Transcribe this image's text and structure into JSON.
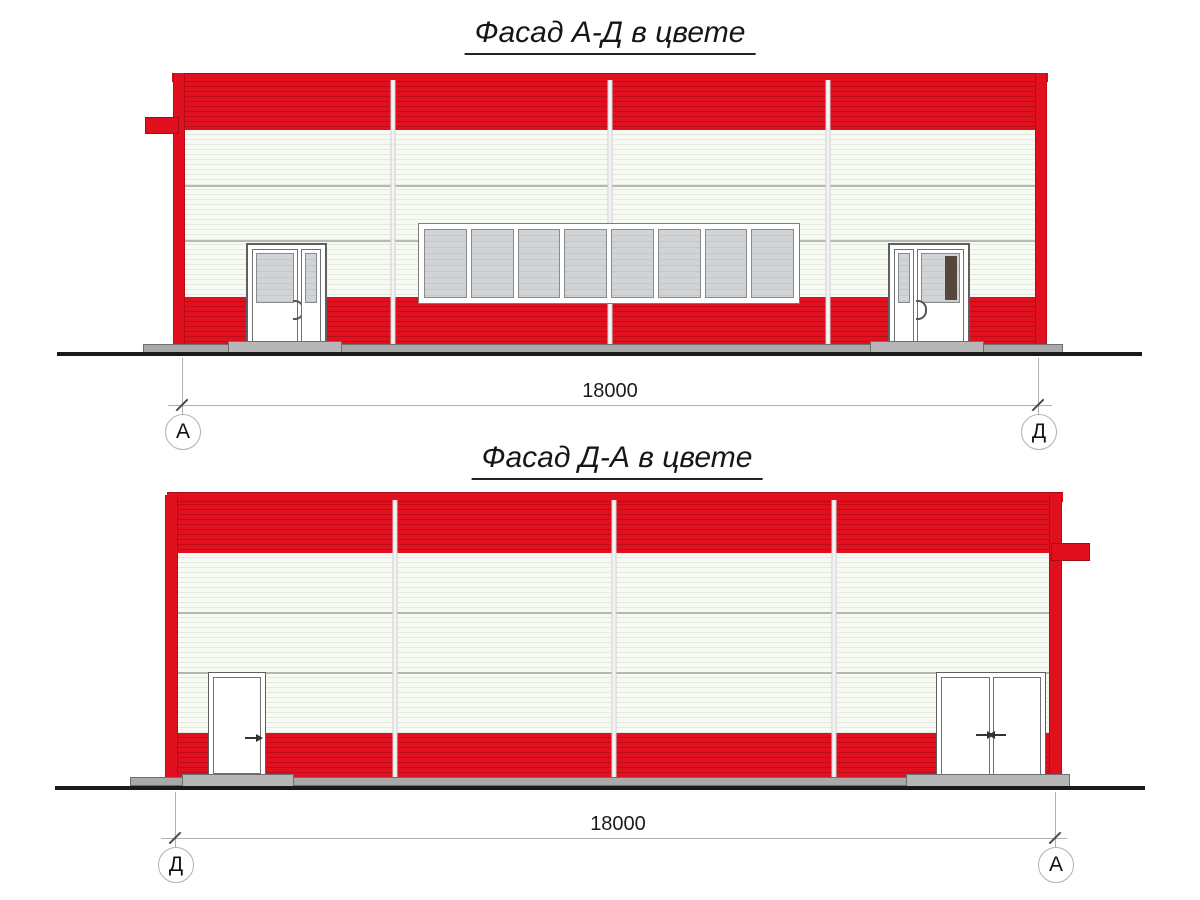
{
  "document": {
    "background": "#ffffff"
  },
  "colors": {
    "facade_red": "#e1101f",
    "facade_red_stripe": "#bd0d1a",
    "siding_white": "#f7f9f3",
    "siding_white_stripe": "#e4eae0",
    "panel_joint": "#a8b0a6",
    "glass_gray": "#d0d4d6",
    "glass_gray_stripe": "#c3c7c9",
    "door_dark_panel": "#57463c",
    "concrete_gray": "#a9a9a9",
    "ground_black": "#1a1a1a",
    "dimension_line": "#b0b0b0"
  },
  "facade_top": {
    "title": "Фасад А-Д в цвете",
    "dimension_label": "18000",
    "axis_left": "А",
    "axis_right": "Д",
    "panel_count": 4,
    "window_pane_count": 8
  },
  "facade_bottom": {
    "title": "Фасад Д-А в цвете",
    "dimension_label": "18000",
    "axis_left": "Д",
    "axis_right": "А",
    "panel_count": 4
  }
}
